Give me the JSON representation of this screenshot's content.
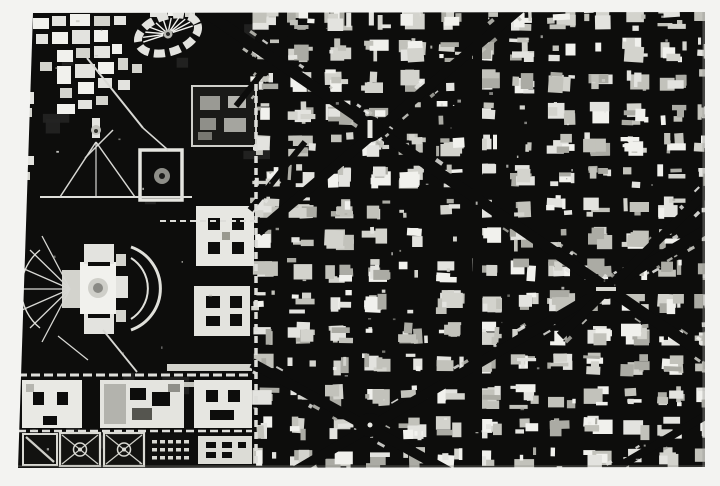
{
  "meta": {
    "description": "High-contrast black-and-white aerial city map artwork print on a light gray wall"
  },
  "scene": {
    "background": "#f3f3f1"
  },
  "artwork": {
    "frame": {
      "left": 18,
      "top": 12,
      "width": 687,
      "height": 456
    },
    "colors": {
      "ink": "#0d0d0c",
      "shades": [
        "#f1f1ed",
        "#e3e3df",
        "#d3d3cd",
        "#c2c2bb",
        "#ababa4"
      ]
    },
    "seed": 1370461,
    "grid": {
      "x0": 250,
      "x1": 710,
      "y0": 6,
      "y1": 470,
      "pitchX": 37,
      "pitchY": 31.5,
      "blockW": 30,
      "blockH": 25
    },
    "leftTexture": {
      "count": 14,
      "x": 20,
      "y": 14,
      "w": 225,
      "h": 446,
      "fill": "#242422"
    },
    "avenues": [
      {
        "x1": 205,
        "y1": 12,
        "x2": 712,
        "y2": 360,
        "w": 11
      },
      {
        "x1": 258,
        "y1": 232,
        "x2": 528,
        "y2": 2,
        "w": 10
      },
      {
        "x1": 252,
        "y1": 363,
        "x2": 462,
        "y2": 479,
        "w": 10
      },
      {
        "x1": 246,
        "y1": 500,
        "x2": 712,
        "y2": 226,
        "w": 10
      },
      {
        "x1": 560,
        "y1": 336,
        "x2": 712,
        "y2": 187,
        "w": 9
      },
      {
        "x1": 236,
        "y1": 106,
        "x2": 290,
        "y2": 38,
        "w": 6
      },
      {
        "x1": 250,
        "y1": 210,
        "x2": 305,
        "y2": 142,
        "w": 6
      },
      {
        "x1": 606,
        "y1": 474,
        "x2": 712,
        "y2": 412,
        "w": 8
      }
    ],
    "wideStreets": [
      {
        "x": 473,
        "y": 12,
        "w": 9,
        "h": 456
      },
      {
        "x": 585,
        "y": 280,
        "w": 122,
        "h": 14
      }
    ],
    "nodes": [
      {
        "x": 370,
        "y": 129,
        "r": 13,
        "mon": true
      },
      {
        "x": 370,
        "y": 425,
        "r": 12,
        "dot": true
      },
      {
        "x": 607,
        "y": 289,
        "r": 10,
        "dash": true
      }
    ],
    "cluster": [
      [
        33,
        18,
        16,
        11,
        0
      ],
      [
        52,
        16,
        14,
        10,
        1
      ],
      [
        70,
        14,
        20,
        12,
        0
      ],
      [
        94,
        16,
        16,
        10,
        2
      ],
      [
        114,
        16,
        12,
        9,
        1
      ],
      [
        150,
        11,
        14,
        6,
        1
      ],
      [
        168,
        11,
        12,
        5,
        0
      ],
      [
        185,
        12,
        10,
        5,
        2
      ],
      [
        36,
        34,
        12,
        10,
        1
      ],
      [
        52,
        32,
        16,
        12,
        0
      ],
      [
        72,
        30,
        18,
        14,
        1
      ],
      [
        94,
        30,
        14,
        12,
        0
      ],
      [
        57,
        50,
        16,
        12,
        0
      ],
      [
        76,
        48,
        14,
        10,
        2
      ],
      [
        94,
        46,
        16,
        12,
        1
      ],
      [
        112,
        44,
        10,
        10,
        0
      ],
      [
        40,
        62,
        12,
        9,
        2
      ],
      [
        57,
        66,
        14,
        18,
        0
      ],
      [
        75,
        64,
        20,
        14,
        1
      ],
      [
        98,
        62,
        16,
        12,
        0
      ],
      [
        118,
        58,
        10,
        12,
        2
      ],
      [
        78,
        82,
        16,
        12,
        0
      ],
      [
        98,
        78,
        14,
        10,
        1
      ],
      [
        60,
        88,
        12,
        10,
        2
      ],
      [
        57,
        104,
        18,
        10,
        0
      ],
      [
        78,
        100,
        14,
        9,
        1
      ],
      [
        96,
        96,
        12,
        9,
        2
      ],
      [
        20,
        92,
        14,
        12,
        1
      ],
      [
        20,
        108,
        12,
        9,
        2
      ],
      [
        22,
        156,
        12,
        9,
        1
      ],
      [
        20,
        172,
        10,
        8,
        2
      ],
      [
        118,
        80,
        12,
        10,
        1
      ],
      [
        132,
        64,
        10,
        9,
        2
      ],
      [
        62,
        270,
        18,
        38,
        2
      ],
      [
        80,
        262,
        36,
        52,
        0
      ],
      [
        84,
        244,
        30,
        20,
        1
      ],
      [
        84,
        314,
        30,
        20,
        1
      ],
      [
        116,
        254,
        10,
        12,
        2
      ],
      [
        116,
        276,
        12,
        22,
        1
      ],
      [
        116,
        310,
        10,
        12,
        2
      ],
      [
        167,
        364,
        85,
        7,
        2
      ],
      [
        167,
        382,
        84,
        5,
        3
      ],
      [
        92,
        118,
        8,
        20,
        1
      ]
    ],
    "inkRects": [
      [
        88,
        262,
        22,
        4
      ],
      [
        88,
        314,
        22,
        4
      ]
    ],
    "buildings": [
      {
        "rect": [
          192,
          86,
          64,
          60
        ],
        "fill": "#1a1a18",
        "stroke": "#cfcfca",
        "sw": 2,
        "inner": [
          [
            200,
            96,
            20,
            14,
            "#9a9a94"
          ],
          [
            228,
            96,
            18,
            12,
            "#b5b5af"
          ],
          [
            200,
            118,
            16,
            12,
            "#8f8f89"
          ],
          [
            224,
            118,
            22,
            14,
            "#a5a59f"
          ],
          [
            198,
            132,
            14,
            8,
            "#777771"
          ]
        ]
      },
      {
        "rect": [
          196,
          206,
          58,
          60
        ],
        "fill": "#e7e7e2",
        "inner": [
          [
            208,
            218,
            12,
            12,
            "#0d0d0c"
          ],
          [
            232,
            218,
            12,
            12,
            "#0d0d0c"
          ],
          [
            208,
            242,
            12,
            12,
            "#0d0d0c"
          ],
          [
            232,
            242,
            12,
            12,
            "#0d0d0c"
          ],
          [
            222,
            232,
            8,
            8,
            "#99998f"
          ]
        ]
      },
      {
        "rect": [
          194,
          286,
          56,
          50
        ],
        "fill": "#e3e3de",
        "inner": [
          [
            206,
            296,
            14,
            12,
            "#0d0d0c"
          ],
          [
            230,
            296,
            12,
            12,
            "#0d0d0c"
          ],
          [
            206,
            316,
            14,
            10,
            "#0d0d0c"
          ],
          [
            230,
            314,
            12,
            12,
            "#0d0d0c"
          ]
        ]
      },
      {
        "rect": [
          194,
          380,
          58,
          48
        ],
        "fill": "#e6e6e1",
        "inner": [
          [
            206,
            390,
            12,
            12,
            "#0d0d0c"
          ],
          [
            228,
            390,
            12,
            12,
            "#0d0d0c"
          ],
          [
            210,
            410,
            24,
            10,
            "#0d0d0c"
          ]
        ]
      },
      {
        "rect": [
          198,
          436,
          54,
          28
        ],
        "fill": "#dcdcd6",
        "inner": [
          [
            206,
            442,
            10,
            6,
            "#0d0d0c"
          ],
          [
            222,
            442,
            10,
            6,
            "#0d0d0c"
          ],
          [
            238,
            442,
            8,
            6,
            "#0d0d0c"
          ],
          [
            206,
            452,
            10,
            6,
            "#0d0d0c"
          ],
          [
            222,
            452,
            10,
            6,
            "#0d0d0c"
          ]
        ]
      },
      {
        "rect": [
          22,
          380,
          60,
          48
        ],
        "fill": "#e9e9e4",
        "inner": [
          [
            33,
            392,
            11,
            13,
            "#0d0d0c"
          ],
          [
            57,
            392,
            11,
            13,
            "#0d0d0c"
          ],
          [
            43,
            416,
            14,
            9,
            "#0d0d0c"
          ],
          [
            26,
            384,
            8,
            8,
            "#b5b5af"
          ]
        ]
      },
      {
        "rect": [
          100,
          380,
          84,
          48
        ],
        "fill": "#e4e4df",
        "inner": [
          [
            104,
            384,
            22,
            40,
            "#b3b3ad"
          ],
          [
            130,
            388,
            16,
            12,
            "#0d0d0c"
          ],
          [
            152,
            392,
            18,
            14,
            "#0d0d0c"
          ],
          [
            168,
            384,
            12,
            8,
            "#8f8f89"
          ],
          [
            132,
            408,
            20,
            12,
            "#55554f"
          ]
        ]
      },
      {
        "rect": [
          140,
          150,
          42,
          50
        ],
        "fill": "#0c0c0b",
        "stroke": "#e5e5e0",
        "sw": 3.5,
        "inner": []
      }
    ],
    "whiteStreets": [
      {
        "x1": 256,
        "y1": 84,
        "x2": 256,
        "y2": 468,
        "w": 3.5,
        "dash": "7 5"
      },
      {
        "x1": 18,
        "y1": 375,
        "x2": 252,
        "y2": 375,
        "w": 3,
        "dash": "9 4"
      },
      {
        "x1": 18,
        "y1": 431,
        "x2": 252,
        "y2": 431,
        "w": 2.5,
        "dash": "8 4"
      },
      {
        "x1": 160,
        "y1": 221,
        "x2": 256,
        "y2": 221,
        "w": 2,
        "dash": "6 4"
      },
      {
        "x1": 40,
        "y1": 197,
        "x2": 192,
        "y2": 197,
        "w": 2,
        "dash": ""
      }
    ],
    "paths": [
      [
        87,
        58,
        143,
        128,
        2
      ],
      [
        113,
        130,
        85,
        158,
        1.5
      ],
      [
        143,
        128,
        168,
        150,
        1.5
      ],
      [
        96,
        142,
        60,
        197,
        1.5
      ],
      [
        96,
        142,
        135,
        197,
        1.5
      ],
      [
        96,
        142,
        96,
        196,
        1.2
      ],
      [
        103,
        330,
        137,
        372,
        1.8
      ],
      [
        58,
        336,
        88,
        360,
        1.2
      ],
      [
        70,
        289,
        30,
        250,
        1.3
      ],
      [
        70,
        289,
        22,
        268,
        1.3
      ],
      [
        70,
        289,
        20,
        289,
        1.3
      ],
      [
        70,
        289,
        22,
        310,
        1.3
      ],
      [
        70,
        289,
        30,
        328,
        1.3
      ],
      [
        70,
        289,
        42,
        342,
        1.3
      ],
      [
        70,
        289,
        42,
        236,
        1.3
      ]
    ],
    "arcs": [
      {
        "d": "M131,247 A44,44 0 0 1 131,330",
        "w": 3
      },
      {
        "d": "M131,258 A36,36 0 0 1 131,319",
        "w": 2
      },
      {
        "d": "M40,250 A50,50 0 0 0 40,328",
        "w": 1.4
      }
    ],
    "oval": {
      "cx": 168,
      "cy": 34,
      "rx": 31,
      "ry": 18,
      "rot": -18,
      "ring": 8,
      "dash": "11 5",
      "spokes": 11
    },
    "circles": [
      [
        98,
        288,
        10,
        "#cfcfc9"
      ],
      [
        98,
        288,
        5,
        "#8a8a85"
      ],
      [
        162,
        176,
        8,
        "#8e8e88"
      ],
      [
        162,
        176,
        3,
        "#1d1d1b"
      ],
      [
        96,
        130,
        5,
        "#c2c2bc"
      ],
      [
        96,
        131,
        2,
        "#35352f"
      ]
    ],
    "parks": [
      {
        "x": 60,
        "y": 433,
        "w": 40,
        "h": 33,
        "type": "target"
      },
      {
        "x": 104,
        "y": 433,
        "w": 40,
        "h": 33,
        "type": "target"
      },
      {
        "x": 148,
        "y": 434,
        "w": 42,
        "h": 32,
        "type": "rows"
      }
    ],
    "triPark": {
      "pts": [
        [
          23,
          434
        ],
        [
          57,
          434
        ],
        [
          57,
          465
        ],
        [
          23,
          465
        ]
      ],
      "diag": [
        26,
        437,
        54,
        462
      ]
    },
    "edges": [
      [
        702.4,
        12,
        2.6,
        456,
        "#9c9c96",
        0.4
      ],
      [
        18,
        465.2,
        687,
        2.0,
        "#8c8c86",
        0.3
      ]
    ],
    "speckCount": 95
  }
}
